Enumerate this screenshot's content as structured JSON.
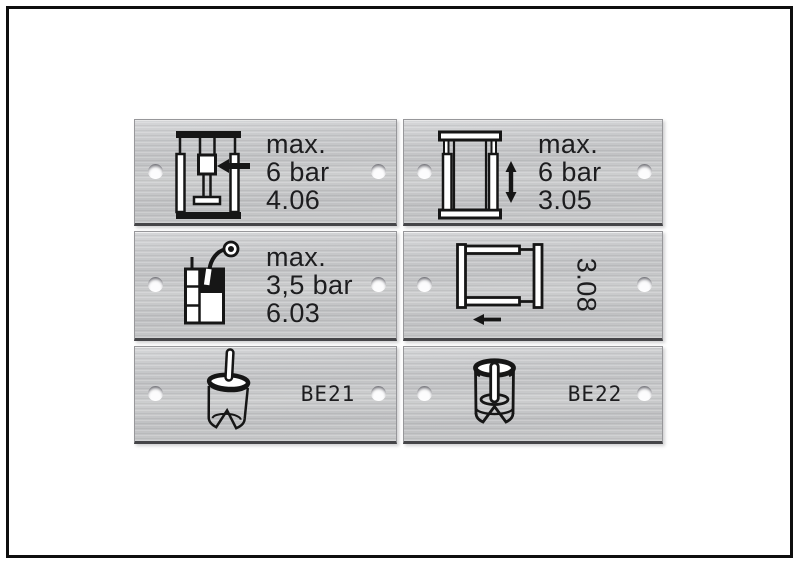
{
  "palette": {
    "background": "#ffffff",
    "border_frame": "#0e0e0e",
    "plate_metal": "#c7c8ca",
    "plate_edge_shadow": "#454548",
    "ink": "#1d1d1f",
    "hole_fill": "#fcfcfd"
  },
  "plates": [
    {
      "id": "4.06",
      "icon": "press-ram-arrow-icon",
      "lines": [
        "max.",
        "6 bar",
        "4.06"
      ]
    },
    {
      "id": "3.05",
      "icon": "frame-vertical-arrow-icon",
      "lines": [
        "max.",
        "6 bar",
        "3.05"
      ]
    },
    {
      "id": "6.03",
      "icon": "pressure-tank-spray-gun-icon",
      "lines": [
        "max.",
        "3,5 bar",
        "6.03"
      ]
    },
    {
      "id": "3.08",
      "icon": "frame-horizontal-arrow-icon",
      "code": "3.08"
    },
    {
      "id": "BE21",
      "icon": "cylinder-pin-icon",
      "code": "BE21"
    },
    {
      "id": "BE22",
      "icon": "sleeve-slot-cylinder-icon",
      "code": "BE22"
    }
  ]
}
